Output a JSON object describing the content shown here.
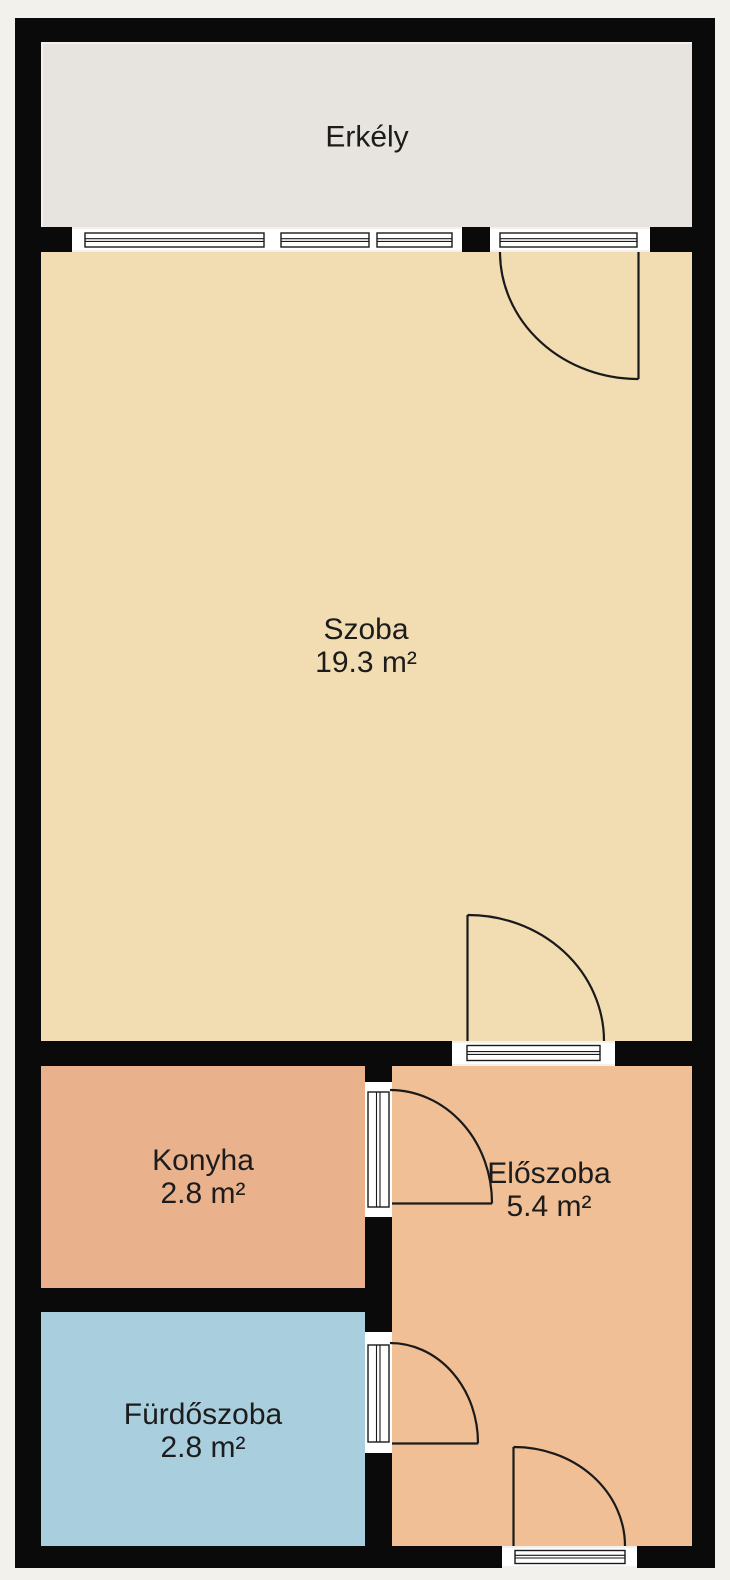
{
  "plan_title": "Floor plan",
  "rooms": [
    {
      "id": "erkely",
      "name": "Erkély",
      "area": ""
    },
    {
      "id": "szoba",
      "name": "Szoba",
      "area": "19.3 m²"
    },
    {
      "id": "konyha",
      "name": "Konyha",
      "area": "2.8 m²"
    },
    {
      "id": "eloszoba",
      "name": "Előszoba",
      "area": "5.4 m²"
    },
    {
      "id": "furdoszoba",
      "name": "Fürdőszoba",
      "area": "2.8 m²"
    }
  ],
  "colors": {
    "background": "#f2f1ec",
    "wall": "#0a0a0a",
    "line": "#1a1a1a",
    "text": "#1c1c1c",
    "opening": "#ffffff",
    "erkely": "#e7e3de",
    "szoba": "#f2ddb3",
    "konyha": "#e9b28d",
    "eloszoba": "#f0bf95",
    "furdoszoba": "#a9cede"
  }
}
